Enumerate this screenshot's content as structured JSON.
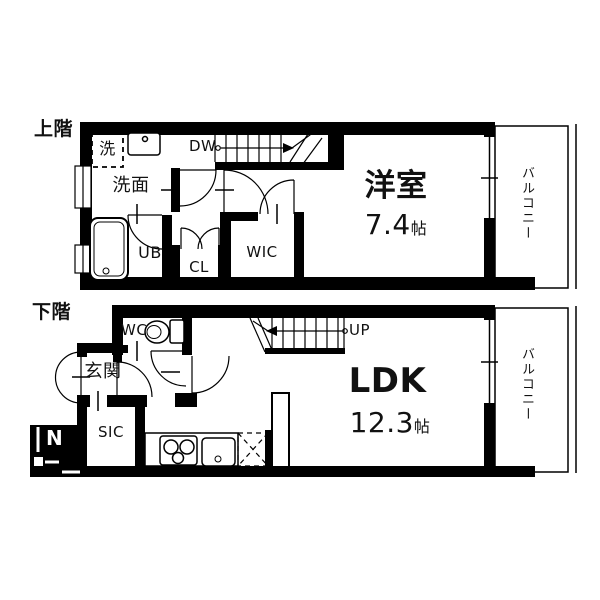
{
  "upper_floor": {
    "floor_label": "上階",
    "room_label": "洋室",
    "room_size_value": "7.4",
    "room_size_unit": "帖",
    "washroom_label": "洗面",
    "washer_label": "洗",
    "bath_label": "UB",
    "closet_label": "CL",
    "wic_label": "WIC",
    "stairs_label": "DW",
    "balcony_label": "バルコニー"
  },
  "lower_floor": {
    "floor_label": "下階",
    "room_label": "LDK",
    "room_size_value": "12.3",
    "room_size_unit": "帖",
    "wc_label": "WC",
    "entrance_label": "玄関",
    "sic_label": "SIC",
    "stairs_label": "UP",
    "balcony_label": "バルコニー"
  },
  "compass": {
    "north_label": "N"
  },
  "colors": {
    "wall": "#000000",
    "background": "#ffffff",
    "text": "#111111"
  }
}
